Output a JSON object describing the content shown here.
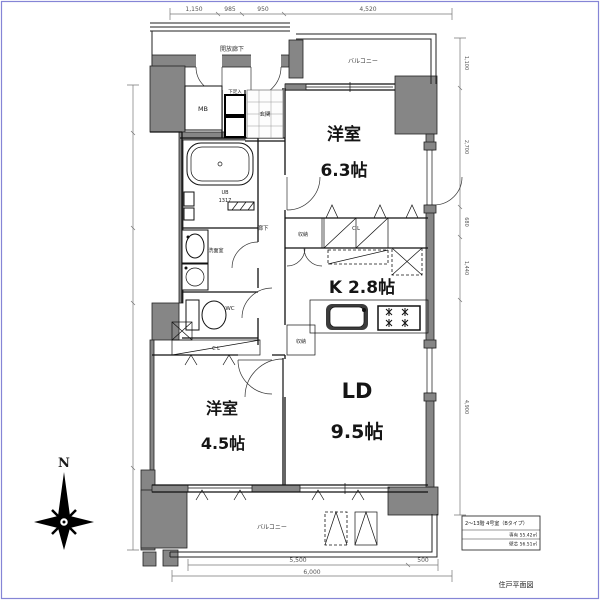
{
  "page": {
    "border_color": "#8585d6",
    "background": "#ffffff"
  },
  "plan": {
    "compass": {
      "label": "N"
    },
    "rooms": {
      "west_room_top": {
        "name": "洋室",
        "size": "6.3帖"
      },
      "kitchen": {
        "name": "K 2.8帖"
      },
      "living_dining": {
        "name": "LD",
        "size": "9.5帖"
      },
      "west_room_bottom": {
        "name": "洋室",
        "size": "4.5帖"
      }
    },
    "labels": {
      "open_corridor": "開放廊下",
      "balcony_top": "バルコニー",
      "balcony_bottom": "バルコニー",
      "meter_box": "MB",
      "shoe_cabinet": "下足入",
      "entrance": "玄関",
      "unit_bath_line1": "UB",
      "unit_bath_line2": "1317",
      "washroom": "洗面室",
      "toilet": "WC",
      "hallway": "廊下",
      "closet_top": "C L",
      "closet_bottom": "C L",
      "storage_top": "収納",
      "storage_mid": "収納"
    },
    "dimensions": {
      "top": [
        "1,150",
        "985",
        "950",
        "4,520"
      ],
      "bottom": [
        "5,500",
        "500"
      ],
      "bottom_total": "6,000",
      "right": [
        "1,100",
        "2,700",
        "680",
        "1,440",
        "4,900"
      ]
    },
    "info_box": {
      "line1": "2〜13階 4号室（Bタイプ）",
      "line2": "専有 55.42㎡",
      "line3": "壁芯 56.51㎡"
    },
    "caption": "住戸平面図"
  }
}
